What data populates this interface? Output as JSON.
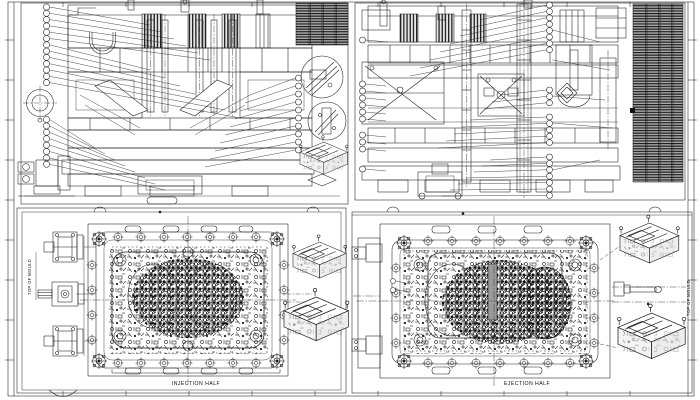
{
  "sheet": {
    "labels": {
      "injection_half": "INJECTION HALF",
      "ejection_half": "EJECTION HALF",
      "top_of_mould_left": "TOP OF MOULD",
      "top_of_mould_right": "TOP OF MOULD"
    },
    "colors": {
      "line": "#1c1c1c",
      "background": "#ffffff",
      "hatch_fill": "#a8a8a8"
    }
  }
}
